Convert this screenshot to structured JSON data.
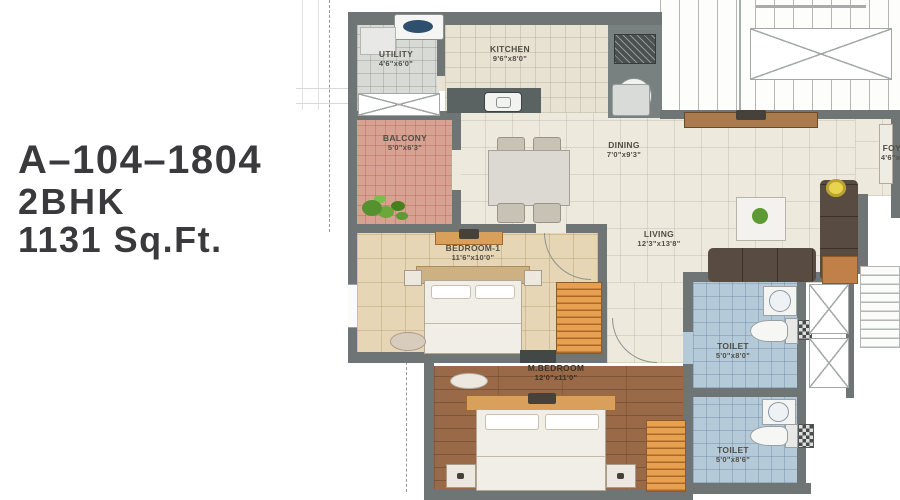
{
  "unit": {
    "code": "A–104–1804",
    "type": "2BHK",
    "area": "1131 Sq.Ft."
  },
  "rooms": [
    {
      "id": "utility",
      "label": "UTILITY",
      "dims": "4'6\"x6'0\""
    },
    {
      "id": "kitchen",
      "label": "KITCHEN",
      "dims": "9'6\"x8'0\""
    },
    {
      "id": "balcony",
      "label": "BALCONY",
      "dims": "5'0\"x6'3\""
    },
    {
      "id": "dining",
      "label": "DINING",
      "dims": "7'0\"x9'3\""
    },
    {
      "id": "foyer",
      "label": "FOYER",
      "dims": "4'6\"x5'0\""
    },
    {
      "id": "living",
      "label": "LIVING",
      "dims": "12'3\"x13'8\""
    },
    {
      "id": "bedroom-1",
      "label": "BEDROOM-1",
      "dims": "11'6\"x10'0\""
    },
    {
      "id": "master-bedroom",
      "label": "M.BEDROOM",
      "dims": "12'0\"x11'0\""
    },
    {
      "id": "toilet-1",
      "label": "TOILET",
      "dims": "5'0\"x8'0\""
    },
    {
      "id": "toilet-2",
      "label": "TOILET",
      "dims": "5'0\"x8'6\""
    }
  ],
  "colors": {
    "title_text": "#3a3a3c",
    "wall": "#6f7475",
    "balcony_floor": "#d8a292",
    "toilet_floor": "#b4cad9",
    "master_bedroom_floor": "#9a6a48",
    "wardrobe": "#e6a04f"
  }
}
